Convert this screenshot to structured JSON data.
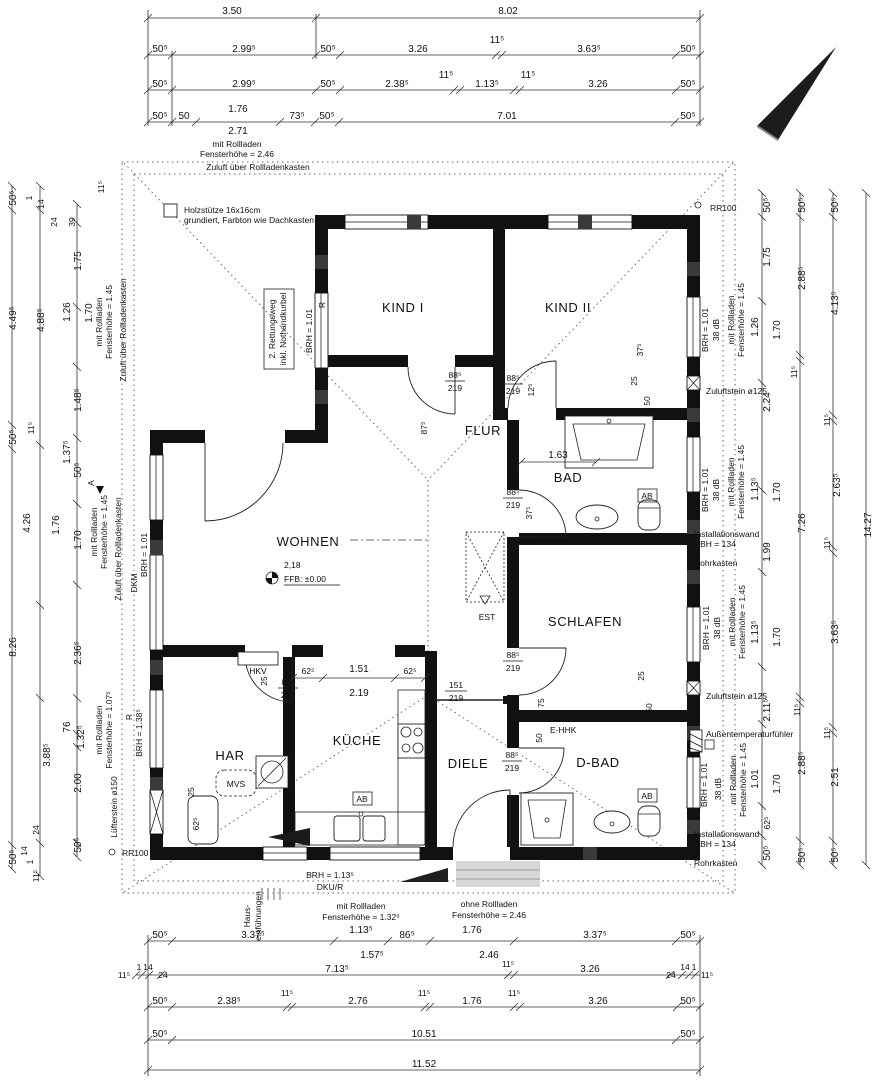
{
  "rooms": {
    "kind1": "KIND I",
    "kind2": "KIND II",
    "flur": "FLUR",
    "bad": "BAD",
    "wohnen": "WOHNEN",
    "schlafen": "SCHLAFEN",
    "har": "HAR",
    "kueche": "KÜCHE",
    "diele": "DIELE",
    "dbad": "D-BAD"
  },
  "door": {
    "w": "88⁵",
    "h": "219"
  },
  "door_wide": {
    "w": "151",
    "h": "219"
  },
  "dims": {
    "top1": [
      "3.50",
      "8.02"
    ],
    "top2": [
      "50⁵",
      "2.99⁵",
      "50⁵",
      "3.26",
      "11⁵",
      "3.63⁵",
      "50⁵"
    ],
    "top3": [
      "50⁵",
      "2.99⁵",
      "50⁵",
      "2.38⁵",
      "11⁵",
      "1.13⁵",
      "11⁵",
      "3.26",
      "50⁵"
    ],
    "top4": [
      "50⁵",
      "50",
      "1.76",
      "2.71",
      "73⁵",
      "50⁵",
      "7.01",
      "50⁵"
    ],
    "bottom1": [
      "50⁵",
      "3.37⁵",
      "1.13⁵",
      "1.57⁵",
      "86⁵",
      "1.76",
      "2.46",
      "3.37⁵",
      "50⁵"
    ],
    "bottom2": [
      "11⁵",
      "1",
      "14",
      "24",
      "7.13⁵",
      "11⁵",
      "3.26",
      "24",
      "14",
      "1",
      "11⁵"
    ],
    "bottom3": [
      "50⁵",
      "2.38⁵",
      "11⁵",
      "2.76",
      "11⁵",
      "1.76",
      "11⁵",
      "3.26",
      "50⁵"
    ],
    "bottom4": [
      "50⁵",
      "10.51",
      "50⁵"
    ],
    "bottom5": [
      "11.52"
    ],
    "left_top": [
      "11⁵",
      "1",
      "14",
      "24",
      "39"
    ],
    "left_a": [
      "50⁵",
      "4.49⁵",
      "50⁵",
      "8.26",
      "50⁵"
    ],
    "left_b": [
      "4.88⁵",
      "11⁵",
      "4.26",
      "1.76",
      "3.88⁵"
    ],
    "left_bot": [
      "24",
      "14",
      "1",
      "11⁵"
    ],
    "left_c": [
      "1.75",
      "1.26",
      "1.70",
      "1.48⁵",
      "50⁵",
      "1.37⁵",
      "1.70",
      "2.36⁵",
      "76",
      "1.32⁵",
      "2.00",
      "50⁵"
    ],
    "right_1": [
      "50⁵",
      "1.75",
      "1.26",
      "1.70",
      "2.24",
      "1.13⁵",
      "1.70",
      "1.99",
      "1.13⁵",
      "1.70",
      "2.11⁵",
      "1.01",
      "1.70",
      "62⁵",
      "50⁵"
    ],
    "right_2": [
      "50⁵",
      "2.88⁵",
      "11⁵",
      "7.26",
      "11⁵",
      "2.88⁵",
      "50⁵"
    ],
    "right_3": [
      "50⁵",
      "4.13⁵",
      "11⁵",
      "2.63⁵",
      "11⁵",
      "3.63⁵",
      "11⁵",
      "2.51",
      "50⁵"
    ],
    "right_4": [
      "14.27"
    ],
    "kitchen": [
      "62⁵",
      "1.51",
      "62⁵",
      "2.19"
    ],
    "small": {
      "d12": "12⁵",
      "d87": "87⁵",
      "d37": "37⁵",
      "d75": "75",
      "d25": "25",
      "d50": "50",
      "d62": "62⁵"
    }
  },
  "n": {
    "zuluft": "Zuluft über Rollladenkasten",
    "holz1": "Holzstütze 16x16cm",
    "holz2": "grundiert, Farbton wie Dachkasten",
    "rett1": "2. Rettungsweg",
    "rett2": "inkl. Nothandkurbel",
    "brh101": "BRH = 1.01",
    "brh138": "BRH = 1.38⁵",
    "brh113": "BRH = 1.13⁵",
    "dku": "DKU/R",
    "dkm": "DKM",
    "r": "R",
    "a": "A",
    "db": "38 dB",
    "mitroll": "mit Rollladen",
    "ohneroll": "ohne Rollladen",
    "fh246": "Fensterhöhe = 2.46",
    "fh145": "Fensterhöhe = 1.45",
    "fh1075": "Fensterhöhe = 1.07⁵",
    "fh1325": "Fensterhöhe = 1.32⁵",
    "zstein": "Zuluftstein ø125",
    "lstein": "Lüfterstein ø150",
    "rr100": "RR100",
    "inst1": "Installationswand",
    "inst2": "RBH = 134",
    "rohr": "Rohrkasten",
    "atf": "Außentemperaturfühler",
    "haus1": "Haus-",
    "haus2": "einführungen",
    "est": "EST",
    "ehhk": "E-HHK",
    "ab": "AB",
    "hkv": "HKV",
    "mvs": "MVS",
    "ffb": "FFB: ±0.00",
    "area": "2,18",
    "tub": "1.63"
  }
}
